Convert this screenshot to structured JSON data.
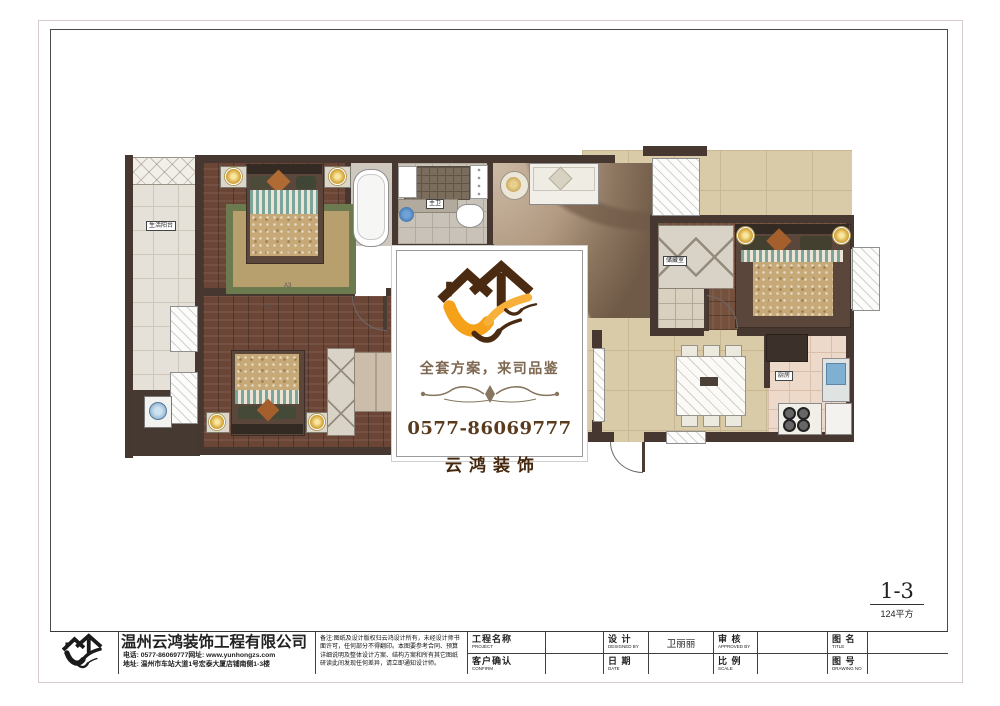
{
  "sheet": {
    "number": "1-3",
    "area": "124平方"
  },
  "center_box": {
    "slogan": "全套方案，来司品鉴",
    "phone": "0577-86069777",
    "brand": "云鸿装饰"
  },
  "plan": {
    "room_labels": {
      "balcony": "生活阳台",
      "master_bath": "主卫",
      "storage": "储藏室",
      "kitchen": "厨房"
    },
    "door_codes": {
      "a": "A3",
      "b": "V1"
    }
  },
  "title_block": {
    "company": {
      "name": "温州云鸿装饰工程有限公司",
      "phone_line": "电话: 0577-86069777网址: www.yunhongzs.com",
      "address_line": "地址: 温州市车站大道1号宏泰大厦店铺南侧1-3楼"
    },
    "notes": "备注:图纸及设计版权归云鸿设计所有，未经设计师书面许可，任何部分不得翻印。本图要参考合同、预算详细说明及整体设计方案、结构方案和所有其它图纸研读此间发现任何差异，请立即通知设计师。",
    "fields": {
      "project": {
        "label": "工程名称",
        "sub": "PROJECT",
        "value": ""
      },
      "confirm": {
        "label": "客户确认",
        "sub": "CONFIRM",
        "value": ""
      },
      "design": {
        "label": "设 计",
        "sub": "DESIGNED BY",
        "value": "卫丽丽"
      },
      "date": {
        "label": "日 期",
        "sub": "DATE",
        "value": ""
      },
      "review": {
        "label": "审 核",
        "sub": "APPROVED BY",
        "value": ""
      },
      "scale": {
        "label": "比 例",
        "sub": "SCALE",
        "value": ""
      },
      "drawing_title": {
        "label": "图 名",
        "sub": "TITLE",
        "value": ""
      },
      "drawing_no": {
        "label": "图 号",
        "sub": "DRAWING NO",
        "value": ""
      }
    }
  },
  "colors": {
    "brand_orange": "#F5A11A",
    "brand_brown": "#4A2A10",
    "wall": "#463830"
  }
}
